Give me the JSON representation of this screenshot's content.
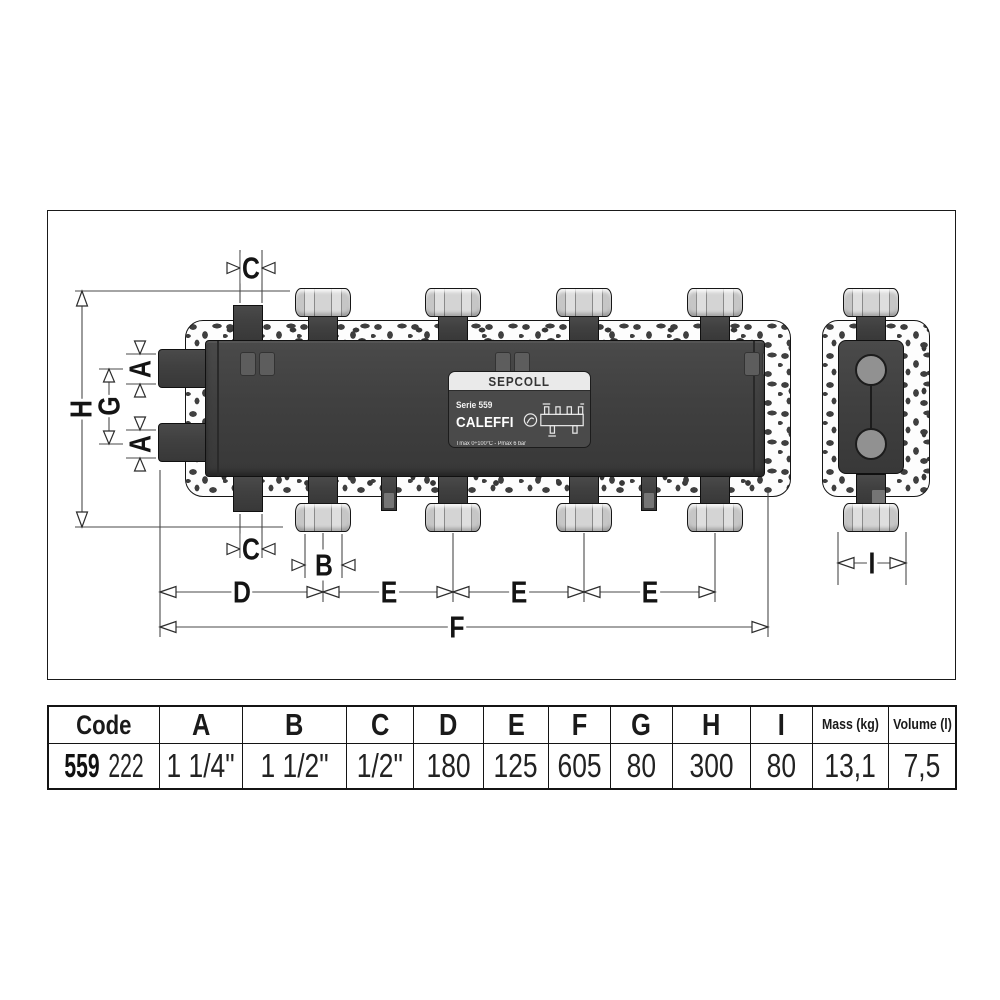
{
  "drawing": {
    "dims": {
      "A": "A",
      "B": "B",
      "C": "C",
      "D": "D",
      "E": "E",
      "F": "F",
      "G": "G",
      "H": "H",
      "I": "I"
    },
    "label": {
      "title": "SEPCOLL",
      "series": "Serie 559",
      "brand": "CALEFFI",
      "specs": "Tmax 0÷100°C - Pmax 6 bar"
    }
  },
  "table": {
    "columns": [
      "Code",
      "A",
      "B",
      "C",
      "D",
      "E",
      "F",
      "G",
      "H",
      "I",
      "Mass (kg)",
      "Volume (l)"
    ],
    "row": {
      "code_prefix": "559",
      "code_suffix": "222",
      "values": [
        "1 1/4\"",
        "1 1/2\"",
        "1/2\"",
        "180",
        "125",
        "605",
        "80",
        "300",
        "80",
        "13,1",
        "7,5"
      ]
    }
  }
}
